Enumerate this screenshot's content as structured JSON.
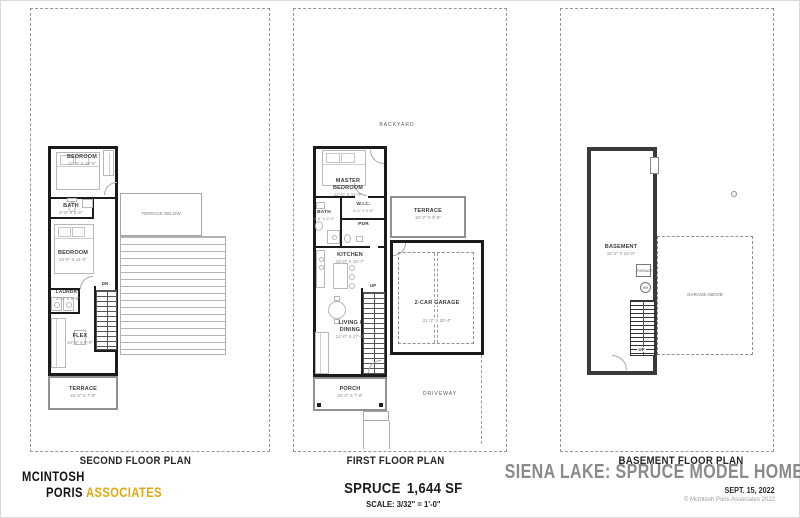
{
  "colors": {
    "accent_gold": "#E2A90F",
    "title_gray": "#8A8A8A",
    "wall": "#1B1B1B"
  },
  "second_floor": {
    "plan_label": "SECOND FLOOR PLAN",
    "bedroom1": {
      "label": "BEDROOM",
      "dim": "12'-0\" X 10'-6\""
    },
    "bath": {
      "label": "BATH",
      "dim": "9'-6\" X 5'-0\""
    },
    "bedroom2": {
      "label": "BEDROOM",
      "dim": "10'-6\" X 11'-0\""
    },
    "laundry": {
      "label": "LAUNDRY",
      "dim": "5'-0\" X 5'-6\""
    },
    "flex": {
      "label": "FLEX",
      "dim": "10'-6\" X 9'-0\""
    },
    "terrace": {
      "label": "TERRACE",
      "dim": "16'-2\" X 7'-8\""
    },
    "terrace_below": {
      "label": "TERRACE BELOW"
    },
    "stair_label": "DN"
  },
  "first_floor": {
    "plan_label": "FIRST FLOOR PLAN",
    "backyard": "BACKYARD",
    "driveway": "DRIVEWAY",
    "master": {
      "label": "MASTER BEDROOM",
      "dim": "12'-0\" X 12'-6\""
    },
    "bath": {
      "label": "BATH",
      "dim": "8'-6\" X 5'-0\""
    },
    "wic": {
      "label": "W.I.C.",
      "dim": "5'-0\" X 5'-8\""
    },
    "pdr": {
      "label": "PDR"
    },
    "kitchen": {
      "label": "KITCHEN",
      "dim": "10'-0\" X 10'-7\""
    },
    "living": {
      "label": "LIVING / DINING",
      "dim": "12'-0\" X 17'-8\""
    },
    "terrace": {
      "label": "TERRACE",
      "dim": "16'-2\" X 9'-8\""
    },
    "garage": {
      "label": "2-CAR GARAGE",
      "dim": "21'-2\" X 20'-4\""
    },
    "porch": {
      "label": "PORCH",
      "dim": "15'-2\" X 7'-8\""
    },
    "stair_label": "UP"
  },
  "basement": {
    "plan_label": "BASEMENT FLOOR PLAN",
    "room": {
      "label": "BASEMENT",
      "dim": "12'-2\" X 34'-0\""
    },
    "furnace": "FURNACE",
    "water_heater": "WH",
    "garage_above": "GARAGE ABOVE",
    "stair_label": "UP"
  },
  "footer": {
    "logo": {
      "line1": "MCINTOSH",
      "line2a": "PORIS",
      "line2b": "ASSOCIATES"
    },
    "model_name": "SPRUCE",
    "model_area": "1,644 SF",
    "scale": "SCALE: 3/32\" = 1'-0\"",
    "title": "SIENA LAKE: SPRUCE MODEL HOME",
    "date": "SEPT. 15, 2022",
    "copyright": "© McIntosh Poris Associates 2022"
  }
}
